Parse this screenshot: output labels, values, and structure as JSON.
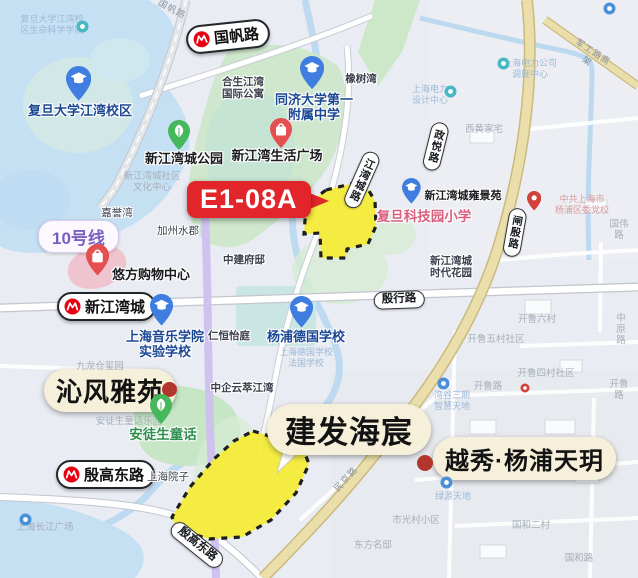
{
  "map": {
    "banner": {
      "text": "E1-08A",
      "color": "#e2242b"
    },
    "line10": {
      "text": "10号线",
      "color": "#7a5fc0"
    },
    "projects": [
      {
        "id": "qinfeng",
        "label": "沁风雅苑"
      },
      {
        "id": "jianfa",
        "label": "建发海宸"
      },
      {
        "id": "yuexiu",
        "label": "越秀·杨浦天玥"
      }
    ],
    "stations": [
      {
        "name": "国帆路"
      },
      {
        "name": "新江湾城"
      },
      {
        "name": "殷高东路"
      }
    ],
    "road_pills": [
      {
        "t": "江湾城路",
        "x": 362,
        "y": 150,
        "r": 24,
        "v": 1
      },
      {
        "t": "政悦路",
        "x": 436,
        "y": 122,
        "r": 14,
        "v": 1
      },
      {
        "t": "闸殷路",
        "x": 515,
        "y": 208,
        "r": 10,
        "v": 1
      },
      {
        "t": "殷行路",
        "x": 399,
        "y": 291,
        "r": -2
      },
      {
        "t": "殷高东路",
        "x": 197,
        "y": 536,
        "r": 39
      }
    ],
    "labels": [
      {
        "t": "复旦大学江湾校\n区生命科学学院",
        "x": 52,
        "y": 14,
        "c": "fntb"
      },
      {
        "t": "复旦大学江湾校区",
        "x": 80,
        "y": 103,
        "c": "sch halo",
        "n": "fudan-campus-label"
      },
      {
        "t": "合生江湾\n国际公寓",
        "x": 243,
        "y": 76,
        "c": "drk b halo"
      },
      {
        "t": "同济大学第一\n附属中学",
        "x": 314,
        "y": 92,
        "c": "sch halo",
        "n": "tongji-school-label"
      },
      {
        "t": "橡树湾",
        "x": 361,
        "y": 73,
        "c": "drk b halo"
      },
      {
        "t": "国帆路",
        "x": 172,
        "y": 4,
        "c": "rf",
        "r": 28
      },
      {
        "t": "新江湾城公园",
        "x": 184,
        "y": 151,
        "c": "blk halo",
        "n": "park-label"
      },
      {
        "t": "新江湾生活广场",
        "x": 277,
        "y": 148,
        "c": "blk halo"
      },
      {
        "t": "新江湾城社区\n文化中心",
        "x": 152,
        "y": 171,
        "c": "fnt"
      },
      {
        "t": "嘉誉湾",
        "x": 117,
        "y": 207,
        "c": "drk halo"
      },
      {
        "t": "加州水郡",
        "x": 178,
        "y": 225,
        "c": "drk halo"
      },
      {
        "t": "中建府邸",
        "x": 244,
        "y": 254,
        "c": "drk b halo"
      },
      {
        "t": "悠方购物中心",
        "x": 151,
        "y": 267,
        "c": "blk halo",
        "n": "umax-mall-label"
      },
      {
        "t": "上海电力\n设计中心",
        "x": 430,
        "y": 84,
        "c": "fntb"
      },
      {
        "t": "上海电力公司\n调度中心",
        "x": 530,
        "y": 58,
        "c": "fntb"
      },
      {
        "t": "西黄家宅",
        "x": 484,
        "y": 124,
        "c": "fnt"
      },
      {
        "t": "军工路高架",
        "x": 590,
        "y": 46,
        "c": "rf",
        "r": 33
      },
      {
        "t": "新江湾城雍景苑",
        "x": 463,
        "y": 190,
        "c": "blksm halo"
      },
      {
        "t": "复旦科技园小学",
        "x": 424,
        "y": 209,
        "c": "pnk halo",
        "n": "fudan-tech-primary-label"
      },
      {
        "t": "中共上海市\n杨浦区委党校",
        "x": 582,
        "y": 194,
        "c": "fntr"
      },
      {
        "t": "国伟路",
        "x": 619,
        "y": 219,
        "c": "fnt"
      },
      {
        "t": "新江湾城\n时代花园",
        "x": 451,
        "y": 255,
        "c": "drk b halo"
      },
      {
        "t": "上海音乐学院\n实验学校",
        "x": 165,
        "y": 329,
        "c": "sch halo"
      },
      {
        "t": "仁恒怡庭",
        "x": 229,
        "y": 330,
        "c": "drk b halo"
      },
      {
        "t": "杨浦德国学校",
        "x": 306,
        "y": 329,
        "c": "sch halo",
        "n": "german-school-label"
      },
      {
        "t": "上海德国学校\n法国学校",
        "x": 306,
        "y": 347,
        "c": "fntb"
      },
      {
        "t": "九龙仓玺园",
        "x": 100,
        "y": 361,
        "c": "fnt"
      },
      {
        "t": "中企云萃江湾",
        "x": 242,
        "y": 382,
        "c": "drk b halo"
      },
      {
        "t": "开鲁六村",
        "x": 537,
        "y": 314,
        "c": "fnt"
      },
      {
        "t": "中原路",
        "x": 621,
        "y": 313,
        "c": "fnt"
      },
      {
        "t": "开鲁五村社区",
        "x": 496,
        "y": 334,
        "c": "fnt"
      },
      {
        "t": "开鲁四村社区",
        "x": 546,
        "y": 368,
        "c": "fnt"
      },
      {
        "t": "安徒生童话乐园",
        "x": 129,
        "y": 416,
        "c": "fnt"
      },
      {
        "t": "安徒生童话",
        "x": 163,
        "y": 427,
        "c": "grn halo",
        "n": "andersen-park-label"
      },
      {
        "t": "上海院子",
        "x": 168,
        "y": 471,
        "c": "drk halo"
      },
      {
        "t": "湾谷三期\n智慧天地",
        "x": 452,
        "y": 390,
        "c": "fntb"
      },
      {
        "t": "开鲁路",
        "x": 488,
        "y": 381,
        "c": "fnt"
      },
      {
        "t": "开鲁路",
        "x": 619,
        "y": 379,
        "c": "fnt"
      },
      {
        "t": "绿源天地",
        "x": 453,
        "y": 491,
        "c": "fntb"
      },
      {
        "t": "市光村小区",
        "x": 416,
        "y": 515,
        "c": "fnt"
      },
      {
        "t": "国和二村",
        "x": 531,
        "y": 520,
        "c": "fnt"
      },
      {
        "t": "东方名邸",
        "x": 373,
        "y": 540,
        "c": "fnt"
      },
      {
        "t": "国和路",
        "x": 579,
        "y": 553,
        "c": "fnt"
      },
      {
        "t": "上海长江广场",
        "x": 45,
        "y": 522,
        "c": "fnt"
      },
      {
        "t": "民京路",
        "x": 346,
        "y": 474,
        "c": "rf",
        "r": -47
      }
    ],
    "pins": [
      {
        "k": "tealdot",
        "x": 76,
        "y": 20
      },
      {
        "k": "school",
        "x": 66,
        "y": 66,
        "s": 1.15
      },
      {
        "k": "school",
        "x": 300,
        "y": 56,
        "s": 1.1
      },
      {
        "k": "park",
        "x": 168,
        "y": 120,
        "s": 1
      },
      {
        "k": "shop",
        "x": 270,
        "y": 118,
        "s": 1
      },
      {
        "k": "tealdot",
        "x": 444,
        "y": 85
      },
      {
        "k": "tealdot",
        "x": 497,
        "y": 57
      },
      {
        "k": "bluedot",
        "x": 603,
        "y": 2
      },
      {
        "k": "school",
        "x": 402,
        "y": 178,
        "s": 0.85
      },
      {
        "k": "redpin",
        "x": 527,
        "y": 191,
        "s": 0.65
      },
      {
        "k": "shop",
        "x": 86,
        "y": 244,
        "s": 1.05
      },
      {
        "k": "school",
        "x": 150,
        "y": 294,
        "s": 1.05
      },
      {
        "k": "school",
        "x": 290,
        "y": 296,
        "s": 1.05
      },
      {
        "k": "park",
        "x": 150,
        "y": 394,
        "s": 1
      },
      {
        "k": "bluedot",
        "x": 437,
        "y": 377
      },
      {
        "k": "reddotsm",
        "x": 520,
        "y": 383
      },
      {
        "k": "bluedot",
        "x": 440,
        "y": 476
      },
      {
        "k": "bluedot",
        "x": 19,
        "y": 513
      }
    ],
    "colors": {
      "parcel_fill": "#f6ec3d",
      "banner_red": "#e2242b",
      "metro_line10": "#cfc0ef",
      "major_road": "#eadfab",
      "water": "#c6e0f3",
      "park_green": "#cde7c9",
      "project_pill_bg": "#f6f0da"
    }
  }
}
